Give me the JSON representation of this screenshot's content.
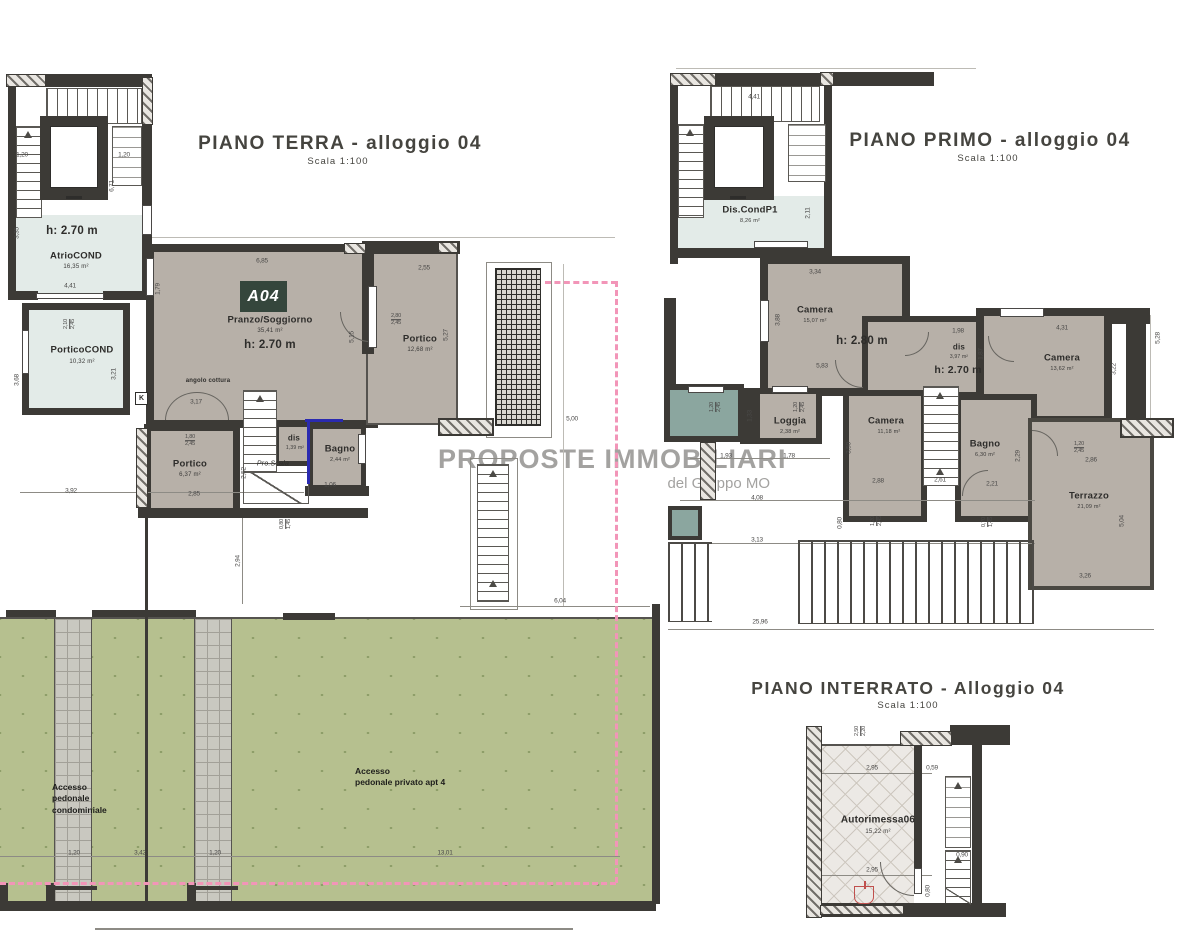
{
  "watermark": {
    "line1": "PROPOSTE IMMOBILIARI",
    "line2": "del Gruppo MO"
  },
  "ground": {
    "title": "PIANO TERRA - alloggio 04",
    "scale": "Scala 1:100",
    "badge": "A04",
    "atrio": {
      "height": "h: 2.70 m",
      "name": "AtrioCOND",
      "area": "16,35 m²"
    },
    "portico_cond": {
      "name": "PorticoCOND",
      "area": "10,32 m²"
    },
    "living": {
      "name": "Pranzo/Soggiorno",
      "area": "35,41 m²",
      "height": "h: 2.70 m"
    },
    "kitchen_note": "angolo cottura",
    "k_marker": "K",
    "stair_note": "Pro.Scala",
    "portico_small": {
      "name": "Portico",
      "area": "6,37 m²"
    },
    "dis": {
      "name": "dis",
      "area": "1,39 m²"
    },
    "bagno": {
      "name": "Bagno",
      "area": "2,44 m²"
    },
    "portico_big": {
      "name": "Portico",
      "area": "12,68 m²"
    },
    "access_condo": "Accesso\npedonale\ncondominiale",
    "access_private": "Accesso\npedonale privato apt 4",
    "dims": [
      {
        "t": "1,20",
        "x": 22,
        "y": 155
      },
      {
        "t": "1,20",
        "x": 124,
        "y": 155
      },
      {
        "t": "6,71",
        "x": 112,
        "y": 186,
        "r": 1
      },
      {
        "t": "3,35",
        "x": 17,
        "y": 233,
        "r": 1
      },
      {
        "t": "4,41",
        "x": 70,
        "y": 286
      },
      {
        "t": "2,10",
        "s": "2,45",
        "x": 70,
        "y": 324,
        "r": 1
      },
      {
        "t": "3,68",
        "x": 17,
        "y": 380,
        "r": 1
      },
      {
        "t": "3,21",
        "x": 114,
        "y": 374,
        "r": 1
      },
      {
        "t": "6,85",
        "x": 262,
        "y": 261
      },
      {
        "t": "1,79",
        "x": 158,
        "y": 289,
        "r": 1
      },
      {
        "t": "5,15",
        "x": 352,
        "y": 337,
        "r": 1
      },
      {
        "t": "2,55",
        "x": 424,
        "y": 268
      },
      {
        "t": "2,80",
        "s": "2,45",
        "x": 396,
        "y": 320
      },
      {
        "t": "5,27",
        "x": 446,
        "y": 335,
        "r": 1
      },
      {
        "t": "3,17",
        "x": 196,
        "y": 402
      },
      {
        "t": "1,80",
        "s": "2,45",
        "x": 190,
        "y": 441
      },
      {
        "t": "2,52",
        "x": 244,
        "y": 473,
        "r": 1
      },
      {
        "t": "2,85",
        "x": 194,
        "y": 494
      },
      {
        "t": "3,92",
        "x": 71,
        "y": 491
      },
      {
        "t": "1,06",
        "x": 330,
        "y": 485
      },
      {
        "t": "0,80",
        "s": "1,45",
        "x": 286,
        "y": 524,
        "r": 1
      },
      {
        "t": "2,94",
        "x": 238,
        "y": 561,
        "r": 1
      },
      {
        "t": "5,00",
        "x": 572,
        "y": 419
      },
      {
        "t": "6,04",
        "x": 560,
        "y": 601
      },
      {
        "t": "1,20",
        "x": 74,
        "y": 853
      },
      {
        "t": "3,42",
        "x": 140,
        "y": 853
      },
      {
        "t": "1,20",
        "x": 215,
        "y": 853
      },
      {
        "t": "13,01",
        "x": 445,
        "y": 853
      }
    ]
  },
  "first": {
    "title": "PIANO PRIMO - alloggio 04",
    "scale": "Scala 1:100",
    "dis_cond": {
      "name": "Dis.CondP1",
      "area": "8,26 m²"
    },
    "camera_top": {
      "name": "Camera",
      "area": "15,07 m²",
      "height": "h: 2.80 m"
    },
    "dis": {
      "name": "dis",
      "area": "3,97 m²",
      "height": "h: 2.70 m"
    },
    "camera_right": {
      "name": "Camera",
      "area": "13,62 m²"
    },
    "camera_mid": {
      "name": "Camera",
      "area": "11,18 m²"
    },
    "loggia": {
      "name": "Loggia",
      "area": "2,38 m²"
    },
    "bagno": {
      "name": "Bagno",
      "area": "6,30 m²"
    },
    "terrazzo": {
      "name": "Terrazzo",
      "area": "21,09 m²"
    },
    "dims": [
      {
        "t": "4,41",
        "x": 754,
        "y": 97
      },
      {
        "t": "2,11",
        "x": 808,
        "y": 213,
        "r": 1
      },
      {
        "t": "3,34",
        "x": 815,
        "y": 272
      },
      {
        "t": "3,88",
        "x": 778,
        "y": 320,
        "r": 1
      },
      {
        "t": "5,83",
        "x": 822,
        "y": 366
      },
      {
        "t": "1,98",
        "x": 958,
        "y": 331
      },
      {
        "t": "1,87",
        "x": 981,
        "y": 354,
        "r": 1
      },
      {
        "t": "4,31",
        "x": 1062,
        "y": 328
      },
      {
        "t": "3,22",
        "x": 1114,
        "y": 369,
        "r": 1
      },
      {
        "t": "5,28",
        "x": 1158,
        "y": 338,
        "r": 1
      },
      {
        "t": "1,20",
        "s": "2,45",
        "x": 716,
        "y": 407,
        "r": 1
      },
      {
        "t": "1,20",
        "s": "2,45",
        "x": 800,
        "y": 407,
        "r": 1
      },
      {
        "t": "1,33",
        "x": 750,
        "y": 416,
        "r": 1
      },
      {
        "t": "3,50",
        "x": 849,
        "y": 448,
        "r": 1
      },
      {
        "t": "2,88",
        "x": 878,
        "y": 481
      },
      {
        "t": "2,61",
        "x": 940,
        "y": 480
      },
      {
        "t": "1,20",
        "s": "2,45",
        "x": 877,
        "y": 521,
        "r": 1
      },
      {
        "t": "0,80",
        "x": 840,
        "y": 523,
        "r": 1
      },
      {
        "t": "1,93",
        "x": 726,
        "y": 456
      },
      {
        "t": "1,78",
        "x": 789,
        "y": 456
      },
      {
        "t": "4,08",
        "x": 757,
        "y": 498
      },
      {
        "t": "3,13",
        "x": 757,
        "y": 540
      },
      {
        "t": "25,96",
        "x": 760,
        "y": 622
      },
      {
        "t": "2,29",
        "x": 1018,
        "y": 456,
        "r": 1
      },
      {
        "t": "2,21",
        "x": 992,
        "y": 484
      },
      {
        "t": "0,70",
        "s": "1,45",
        "x": 988,
        "y": 522,
        "r": 1
      },
      {
        "t": "2,86",
        "x": 1091,
        "y": 460
      },
      {
        "t": "1,20",
        "s": "2,45",
        "x": 1079,
        "y": 448
      },
      {
        "t": "5,04",
        "x": 1122,
        "y": 521,
        "r": 1
      },
      {
        "t": "3,26",
        "x": 1085,
        "y": 576
      }
    ]
  },
  "basement": {
    "title": "PIANO INTERRATO - Alloggio 04",
    "scale": "Scala 1:100",
    "garage": {
      "name": "Autorimessa06",
      "area": "15,22 m²"
    },
    "dims": [
      {
        "t": "2,50",
        "s": "2,20",
        "x": 861,
        "y": 731,
        "r": 1
      },
      {
        "t": "2,95",
        "x": 872,
        "y": 768
      },
      {
        "t": "0,59",
        "x": 932,
        "y": 768
      },
      {
        "t": "2,95",
        "x": 872,
        "y": 870
      },
      {
        "t": "0,80",
        "x": 928,
        "y": 891,
        "r": 1
      },
      {
        "t": "0,90",
        "x": 962,
        "y": 855
      }
    ]
  }
}
